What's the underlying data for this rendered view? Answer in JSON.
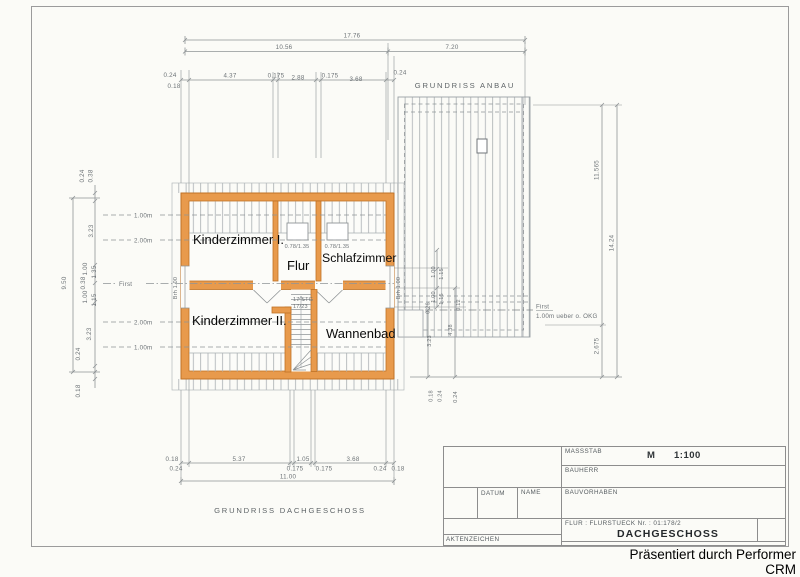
{
  "watermark": "Präsentiert durch Performer CRM",
  "titles": {
    "plan": "GRUNDRISS DACHGESCHOSS",
    "annex": "GRUNDRISS ANBAU"
  },
  "rooms": {
    "k1": "Kinderzimmer I.",
    "flur": "Flur",
    "schlaf": "Schlafzimmer",
    "k2": "Kinderzimmer II.",
    "bad": "Wannenbad"
  },
  "ann": {
    "win1": "0.78/1.35",
    "win2": "0.78/1.35",
    "stg1": "17 STG",
    "stg2": "17/23",
    "brh_left": "Brh 1.00",
    "brh_right": "Brh 1.00",
    "first_left": "First",
    "first_right1": "First",
    "first_right2": "1.00m ueber o. OKG",
    "h1": "1.00m",
    "h2": "2.00m",
    "h3": "2.00m",
    "h4": "1.00m"
  },
  "dims": {
    "top": {
      "total": "17.76",
      "house": "10.56",
      "annex": "7.20",
      "c": [
        "0.24",
        "4.37",
        "0.175",
        "2.88",
        "0.175",
        "3.68",
        "0.24"
      ],
      "sub": "0.18"
    },
    "bottom": {
      "total": "11.00",
      "c": [
        "0.18",
        "0.24",
        "5.37",
        "0.175",
        "1.05",
        "0.175",
        "3.68",
        "0.24",
        "0.18"
      ]
    },
    "left": {
      "total": "9.50",
      "c": [
        "0.24",
        "0.38",
        "3.23",
        "1.00",
        "1.35",
        "0.38",
        "1.00",
        "1.15",
        "3.23",
        "0.24",
        "0.18"
      ]
    },
    "right": {
      "c": [
        "1.00",
        "1.15",
        "1.00",
        "1.15",
        "0.26",
        "0.12",
        "4.38",
        "3.23",
        "0.18",
        "0.24",
        "0.24"
      ]
    },
    "annex": {
      "inner": "11.565",
      "lower": "2.675",
      "total": "14.24"
    }
  },
  "titleblock": {
    "massstab_label": "MASSSTAB",
    "scale_prefix": "M",
    "scale": "1:100",
    "bauherr": "BAUHERR",
    "datum": "DATUM",
    "name": "NAME",
    "bauvorhaben": "BAUVORHABEN",
    "flur_line": "FLUR : FLURSTUECK Nr. : 01:178/2",
    "sheet": "DACHGESCHOSS",
    "aktenzeichen": "AKTENZEICHEN"
  }
}
